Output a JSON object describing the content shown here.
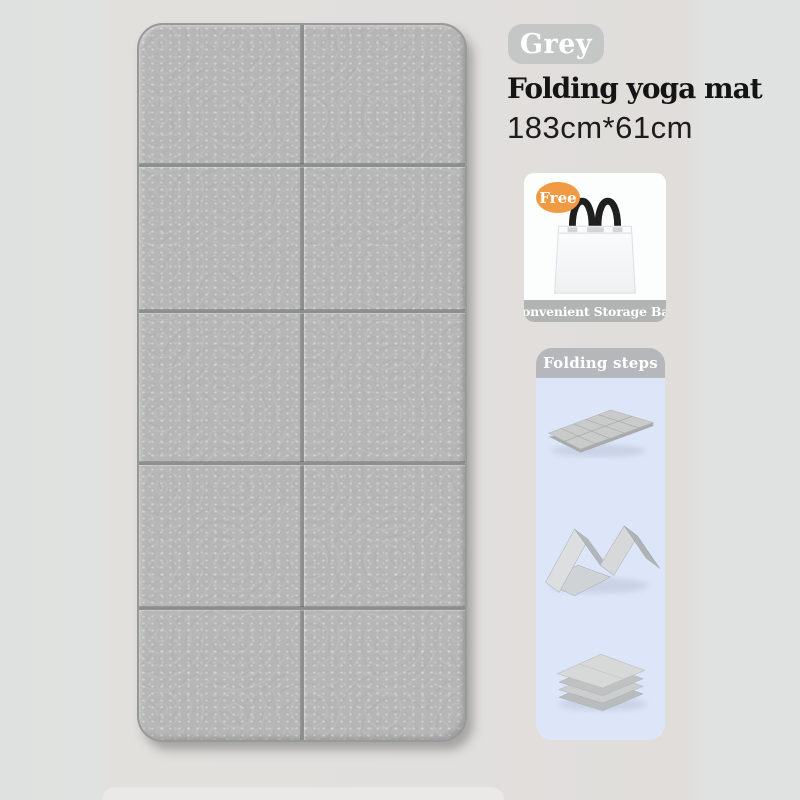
{
  "colors": {
    "page_bg": "#e1e0de",
    "mat_surface": "#b5b6b5",
    "mat_fold_line": "#8d8f8e",
    "color_badge_bg": "#c5c7c6",
    "free_badge_bg": "#f09b43",
    "caption_bar_bg": "#b2b4b4",
    "steps_header_bg": "#b5b7bb",
    "steps_panel_bg": "#dde6f8"
  },
  "product": {
    "color_label": "Grey",
    "title": "Folding yoga mat",
    "size": "183cm*61cm",
    "mat_grid": {
      "columns": 2,
      "rows": 5
    }
  },
  "freebie": {
    "badge_label": "Free",
    "caption": "Convenient Storage Bag",
    "image": "white-tote-storage-bag"
  },
  "folding_steps": {
    "header": "Folding steps",
    "steps": [
      {
        "image": "flat-open-mat"
      },
      {
        "image": "accordion-zigzag-folded-mat"
      },
      {
        "image": "fully-folded-stacked-mat"
      }
    ]
  }
}
